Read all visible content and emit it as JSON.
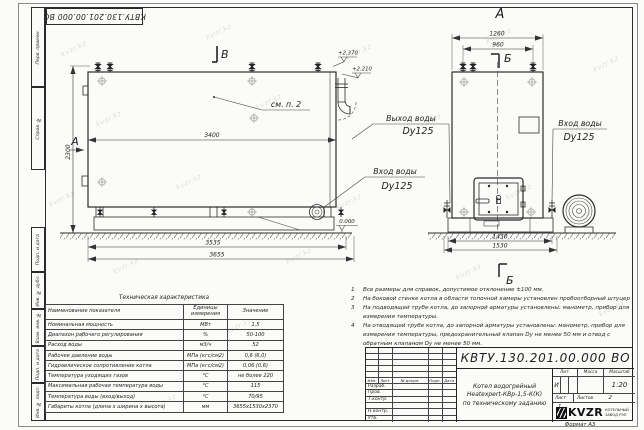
{
  "watermark": "kvzr.kz",
  "stamp": {
    "number": "КВТУ.130.201.00.000  ВО"
  },
  "margins": {
    "top": [
      {
        "label": "Перв. примен."
      },
      {
        "label": "Справ. №"
      }
    ],
    "bottom": [
      {
        "label": "Подп. и дата"
      },
      {
        "label": "Инв. № дубл."
      },
      {
        "label": "Взам. инв. №"
      },
      {
        "label": "Подп. и дата"
      },
      {
        "label": "Инв. № подл."
      }
    ]
  },
  "views": {
    "side": {
      "section_top": "В",
      "section_left": "А",
      "dim_width": "3400",
      "dim_height": "2300",
      "dim_base1": "3535",
      "dim_base2": "3655",
      "callout": "см. п. 2",
      "elev1": "+2.370",
      "elev2": "+2.210",
      "elev_zero": "0.000",
      "inlet_label": "Вход воды",
      "inlet_dn": "Dy125"
    },
    "front": {
      "view_label": "А",
      "section_label": "Б",
      "dim_top1": "1260",
      "dim_top2": "960",
      "dim_base1": "1430",
      "dim_base2": "1530",
      "outlet_label": "Выход воды",
      "outlet_dn": "Dy125",
      "inlet_label": "Вход воды",
      "inlet_dn": "Dy125"
    }
  },
  "tech_table": {
    "title": "Техническая характеристика",
    "headers": [
      "Наименование показателя",
      "Единицы измерения",
      "Значение"
    ],
    "rows": [
      [
        "Номинальная мощность",
        "МВт",
        "1,5"
      ],
      [
        "Диапазон рабочего регулирования",
        "%",
        "50-100"
      ],
      [
        "Расход воды",
        "м3/ч",
        "52"
      ],
      [
        "Рабочее давление воды",
        "МПа (кгс/см2)",
        "0,6 (6,0)"
      ],
      [
        "Гидравлическое сопротивление котла",
        "МПа (кгс/см2)",
        "0,06 (0,6)"
      ],
      [
        "Температура уходящих газов",
        "°С",
        "не более 220"
      ],
      [
        "Максимальная рабочая температура воды",
        "°С",
        "115"
      ],
      [
        "Температура воды (вход/выход)",
        "°С",
        "70/95"
      ],
      [
        "Габариты котла (длина х ширина х высота)",
        "мм",
        "3655х1530х2370"
      ]
    ]
  },
  "notes": [
    {
      "num": "1",
      "text": "Все размеры для справок, допустимое отклонение ±100 мм."
    },
    {
      "num": "2",
      "text": "На боковой стенке котла в области топочной камеры установлен пробоотборный штуцер"
    },
    {
      "num": "3",
      "text": "На подводящей трубе котла, до запорной арматуры установлены: манометр, прибор для измерения температуры."
    },
    {
      "num": "4",
      "text": "На отводящей трубе котла, до запорной арматуры установлены: манометр, прибор для измерения температуры, предохранительный клапан Dу не менее 50 мм и отвод с обратным клапаном Dу не менее 50 мм."
    }
  ],
  "titleblock": {
    "doc_number": "КВТУ.130.201.00.000  ВО",
    "product_line1": "Котел водогрейный",
    "product_line2": "Heatexpert-КВр-1,5-К(К)",
    "product_line3": "по техническому заданию",
    "rev_headers": [
      "Изм.",
      "Лист",
      "№ докум.",
      "Подп.",
      "Дата"
    ],
    "sign_rows": [
      "Разраб.",
      "Пров.",
      "Т.контр.",
      "",
      "Н.контр.",
      "Утв."
    ],
    "lit_header": "Лит.",
    "mass_header": "Масса",
    "scale_header": "Масштаб",
    "lit_value": "И",
    "scale_value": "1:20",
    "sheet_label": "Лист",
    "sheet_value": "1",
    "sheets_label": "Листов",
    "sheets_value": "2",
    "logo_text": "KVZR",
    "company_line1": "КОТЕЛЬНЫЙ",
    "company_line2": "ЗАВОД РЭП",
    "format": "Формат  А3"
  }
}
